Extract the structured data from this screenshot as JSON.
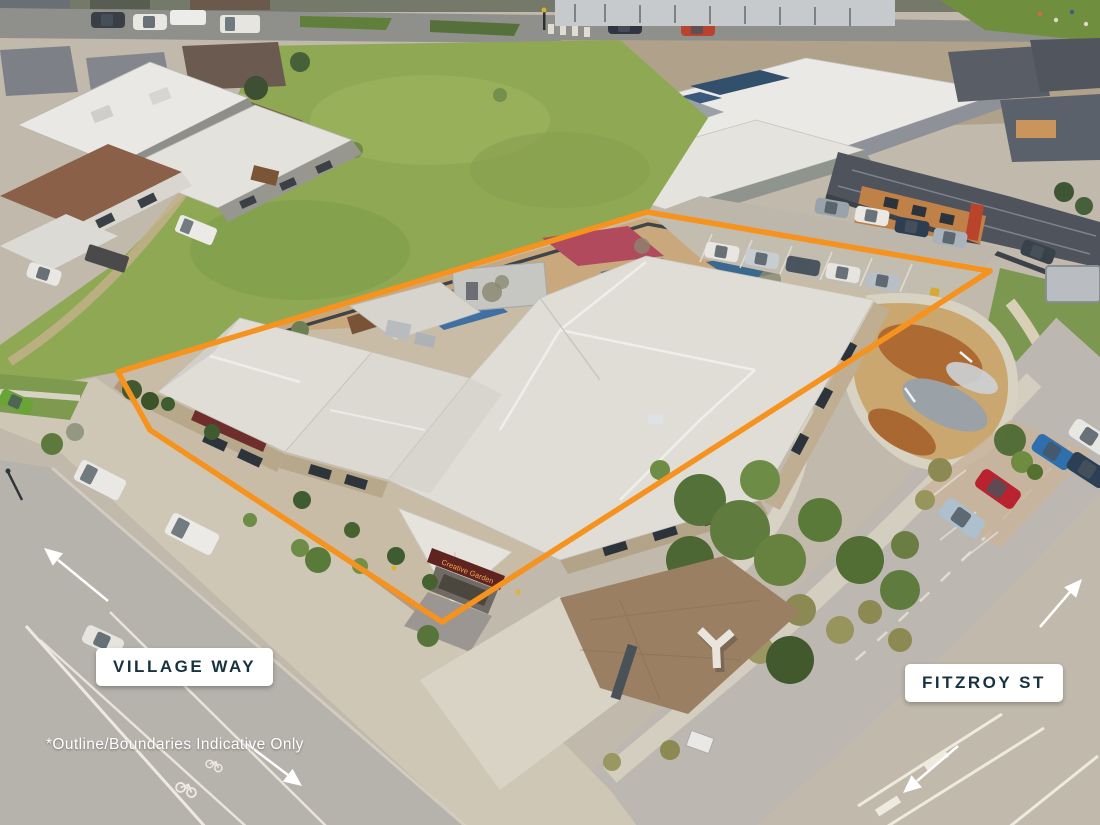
{
  "overlay": {
    "street_labels": [
      {
        "id": "village-way",
        "text": "VILLAGE WAY"
      },
      {
        "id": "fitzroy-st",
        "text": "FITZROY ST"
      }
    ],
    "disclaimer": "*Outline/Boundaries Indicative Only",
    "arrows": [
      {
        "name": "village-way-arrow-north",
        "direction": "up-left"
      },
      {
        "name": "village-way-arrow-south",
        "direction": "down-right"
      },
      {
        "name": "fitzroy-st-arrow-north",
        "direction": "up-right"
      },
      {
        "name": "fitzroy-st-arrow-south",
        "direction": "down-left"
      }
    ]
  },
  "property": {
    "building_sign": "Creative Garden",
    "scene_description": "Aerial drone photo of a single-storey childcare centre with light grey roof, playground shade sails and on-site parking, outlined in orange at the corner of Village Way and Fitzroy St"
  },
  "colors": {
    "boundary": "#F6921E",
    "label_text": "#17333F",
    "label_background": "#FFFFFF",
    "disclaimer_text": "#FFFFFF",
    "arrow": "#FFFFFF"
  }
}
